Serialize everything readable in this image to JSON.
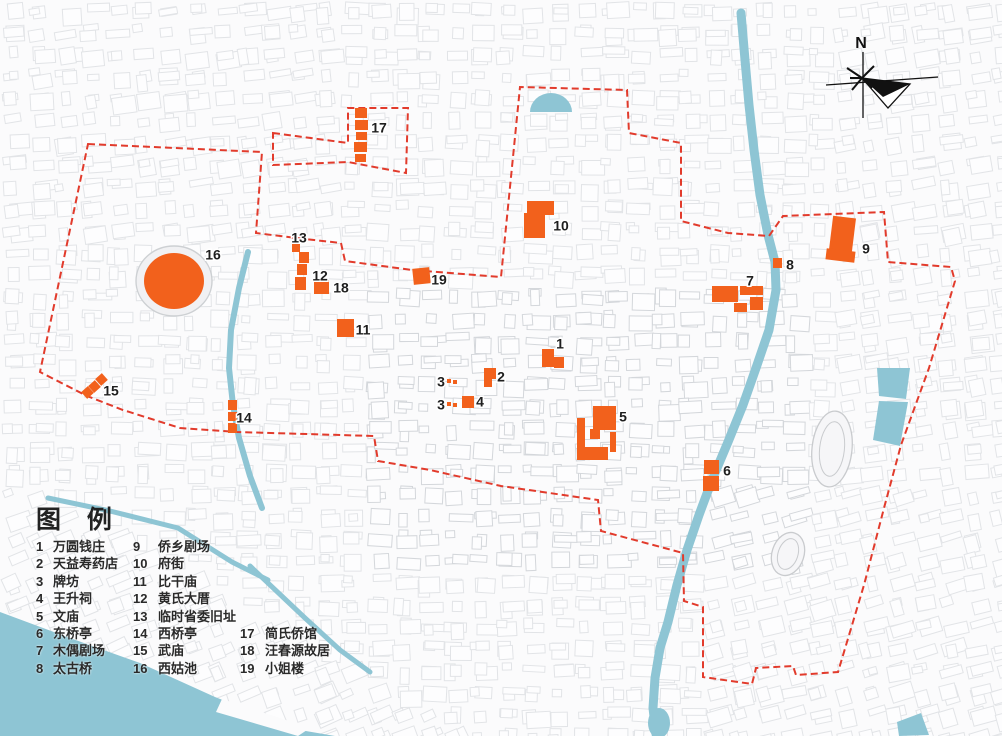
{
  "title": "历史街区保护规划图",
  "colors": {
    "site_orange": "#f2611c",
    "boundary_red": "#e23b2c",
    "water_teal": "#8ec5d4",
    "fabric_line": "#e2e4e7",
    "fabric_line_dense": "#d4d7db",
    "text": "#262626"
  },
  "north_indicator": {
    "label": "N"
  },
  "legend": {
    "title": "图  例",
    "columns": [
      {
        "items": [
          {
            "num": "1",
            "label": "万圆钱庄"
          },
          {
            "num": "2",
            "label": "天益寿药店"
          },
          {
            "num": "3",
            "label": "牌坊"
          },
          {
            "num": "4",
            "label": "王升祠"
          },
          {
            "num": "5",
            "label": "文庙"
          },
          {
            "num": "6",
            "label": "东桥亭"
          },
          {
            "num": "7",
            "label": "木偶剧场"
          },
          {
            "num": "8",
            "label": "太古桥"
          }
        ]
      },
      {
        "items": [
          {
            "num": "9",
            "label": "侨乡剧场"
          },
          {
            "num": "10",
            "label": "府街"
          },
          {
            "num": "11",
            "label": "比干庙"
          },
          {
            "num": "12",
            "label": "黄氏大厝"
          },
          {
            "num": "13",
            "label": "临时省委旧址"
          },
          {
            "num": "14",
            "label": "西桥亭"
          },
          {
            "num": "15",
            "label": "武庙"
          },
          {
            "num": "16",
            "label": "西姑池"
          }
        ]
      },
      {
        "items": [
          {
            "num": "17",
            "label": "简氏侨馆"
          },
          {
            "num": "18",
            "label": "汪春源故居"
          },
          {
            "num": "19",
            "label": "小姐楼"
          }
        ]
      }
    ]
  },
  "map": {
    "markers": [
      {
        "n": "1",
        "x": 560,
        "y": 345
      },
      {
        "n": "2",
        "x": 501,
        "y": 378
      },
      {
        "n": "3",
        "x": 441,
        "y": 383
      },
      {
        "n": "3",
        "x": 441,
        "y": 406
      },
      {
        "n": "4",
        "x": 480,
        "y": 403
      },
      {
        "n": "5",
        "x": 623,
        "y": 418
      },
      {
        "n": "6",
        "x": 727,
        "y": 472
      },
      {
        "n": "7",
        "x": 750,
        "y": 282
      },
      {
        "n": "8",
        "x": 790,
        "y": 266
      },
      {
        "n": "9",
        "x": 866,
        "y": 250
      },
      {
        "n": "10",
        "x": 561,
        "y": 227
      },
      {
        "n": "11",
        "x": 363,
        "y": 331
      },
      {
        "n": "12",
        "x": 320,
        "y": 277
      },
      {
        "n": "13",
        "x": 299,
        "y": 239
      },
      {
        "n": "14",
        "x": 244,
        "y": 419
      },
      {
        "n": "15",
        "x": 111,
        "y": 392
      },
      {
        "n": "16",
        "x": 213,
        "y": 256
      },
      {
        "n": "17",
        "x": 379,
        "y": 129
      },
      {
        "n": "18",
        "x": 341,
        "y": 289
      },
      {
        "n": "19",
        "x": 439,
        "y": 281
      }
    ],
    "site_rects": [
      {
        "site": "1",
        "r": [
          [
            542,
            349,
            12,
            18,
            0
          ],
          [
            554,
            357,
            10,
            11,
            0
          ]
        ]
      },
      {
        "site": "2",
        "r": [
          [
            484,
            368,
            12,
            11,
            0
          ],
          [
            484,
            379,
            8,
            8,
            0
          ]
        ]
      },
      {
        "site": "3",
        "r": [
          [
            447,
            379,
            4,
            4,
            0
          ],
          [
            453,
            380,
            4,
            4,
            0
          ],
          [
            447,
            402,
            4,
            4,
            0
          ],
          [
            453,
            403,
            4,
            4,
            0
          ]
        ]
      },
      {
        "site": "4",
        "r": [
          [
            462,
            396,
            12,
            12,
            0
          ]
        ]
      },
      {
        "site": "5",
        "r": [
          [
            593,
            406,
            23,
            24,
            0
          ],
          [
            577,
            418,
            8,
            42,
            0
          ],
          [
            580,
            447,
            28,
            13,
            0
          ],
          [
            590,
            429,
            10,
            10,
            0
          ],
          [
            610,
            432,
            6,
            20,
            0
          ]
        ]
      },
      {
        "site": "6",
        "r": [
          [
            704,
            460,
            15,
            14,
            0
          ],
          [
            703,
            476,
            16,
            15,
            0
          ]
        ]
      },
      {
        "site": "7",
        "r": [
          [
            712,
            286,
            26,
            16,
            0
          ],
          [
            740,
            286,
            23,
            9,
            0
          ],
          [
            750,
            297,
            13,
            13,
            0
          ],
          [
            734,
            303,
            13,
            9,
            0
          ]
        ]
      },
      {
        "site": "8",
        "r": [
          [
            773,
            258,
            9,
            10,
            0
          ]
        ]
      },
      {
        "site": "9",
        "r": [
          [
            831,
            217,
            23,
            34,
            7
          ],
          [
            826,
            250,
            29,
            11,
            7
          ]
        ]
      },
      {
        "site": "10",
        "r": [
          [
            527,
            201,
            27,
            14,
            0
          ],
          [
            524,
            213,
            21,
            25,
            0
          ]
        ]
      },
      {
        "site": "11",
        "r": [
          [
            337,
            319,
            17,
            18,
            0
          ]
        ]
      },
      {
        "site": "12",
        "r": [
          [
            299,
            252,
            10,
            11,
            0
          ],
          [
            297,
            264,
            10,
            11,
            0
          ],
          [
            295,
            277,
            11,
            13,
            0
          ]
        ]
      },
      {
        "site": "13",
        "r": [
          [
            292,
            244,
            8,
            8,
            0
          ]
        ]
      },
      {
        "site": "14",
        "r": [
          [
            228,
            400,
            9,
            10,
            0
          ],
          [
            228,
            412,
            9,
            9,
            0
          ],
          [
            228,
            423,
            9,
            10,
            0
          ]
        ]
      },
      {
        "site": "15",
        "r": [
          [
            83,
            388,
            9,
            9,
            -42
          ],
          [
            90,
            382,
            9,
            9,
            -42
          ],
          [
            97,
            375,
            9,
            9,
            -42
          ]
        ]
      },
      {
        "site": "17",
        "r": [
          [
            355,
            108,
            12,
            10,
            0
          ],
          [
            355,
            120,
            13,
            10,
            0
          ],
          [
            356,
            132,
            11,
            8,
            0
          ],
          [
            354,
            142,
            13,
            10,
            0
          ],
          [
            355,
            154,
            11,
            8,
            0
          ]
        ]
      },
      {
        "site": "18",
        "r": [
          [
            314,
            280,
            15,
            14,
            0
          ]
        ]
      },
      {
        "site": "19",
        "r": [
          [
            413,
            268,
            17,
            16,
            -6
          ]
        ]
      }
    ],
    "site_pond": {
      "site": "16",
      "cx": 174,
      "cy": 281,
      "rx": 30,
      "ry": 28
    },
    "boundary_main": [
      [
        88,
        144
      ],
      [
        262,
        152
      ],
      [
        256,
        233
      ],
      [
        296,
        238
      ],
      [
        341,
        243
      ],
      [
        345,
        261
      ],
      [
        412,
        270
      ],
      [
        501,
        277
      ],
      [
        520,
        87
      ],
      [
        627,
        90
      ],
      [
        629,
        133
      ],
      [
        681,
        143
      ],
      [
        681,
        221
      ],
      [
        728,
        233
      ],
      [
        769,
        236
      ],
      [
        783,
        216
      ],
      [
        884,
        212
      ],
      [
        888,
        262
      ],
      [
        951,
        267
      ],
      [
        955,
        281
      ],
      [
        929,
        368
      ],
      [
        901,
        445
      ],
      [
        884,
        508
      ],
      [
        864,
        585
      ],
      [
        838,
        672
      ],
      [
        796,
        675
      ],
      [
        793,
        666
      ],
      [
        756,
        668
      ],
      [
        752,
        684
      ],
      [
        703,
        677
      ],
      [
        703,
        607
      ],
      [
        684,
        601
      ],
      [
        683,
        553
      ],
      [
        601,
        531
      ],
      [
        598,
        500
      ],
      [
        501,
        486
      ],
      [
        430,
        470
      ],
      [
        378,
        461
      ],
      [
        374,
        436
      ],
      [
        237,
        432
      ],
      [
        180,
        428
      ],
      [
        123,
        410
      ],
      [
        87,
        396
      ],
      [
        40,
        372
      ]
    ],
    "boundary_annex": [
      [
        273,
        133
      ],
      [
        348,
        143
      ],
      [
        348,
        108
      ],
      [
        408,
        108
      ],
      [
        406,
        173
      ],
      [
        348,
        162
      ],
      [
        273,
        165
      ]
    ],
    "canals": [
      {
        "w": 9,
        "pts": [
          [
            741,
            13
          ],
          [
            745,
            60
          ],
          [
            749,
            105
          ],
          [
            754,
            150
          ],
          [
            760,
            195
          ],
          [
            768,
            235
          ],
          [
            775,
            262
          ],
          [
            776,
            290
          ],
          [
            769,
            330
          ],
          [
            756,
            368
          ],
          [
            743,
            405
          ],
          [
            728,
            442
          ],
          [
            712,
            480
          ],
          [
            699,
            515
          ],
          [
            687,
            550
          ],
          [
            677,
            585
          ],
          [
            668,
            622
          ],
          [
            660,
            648
          ],
          [
            655,
            678
          ],
          [
            653,
            708
          ],
          [
            656,
            734
          ]
        ]
      },
      {
        "w": 6,
        "pts": [
          [
            248,
            252
          ],
          [
            239,
            288
          ],
          [
            231,
            330
          ],
          [
            229,
            368
          ],
          [
            233,
            405
          ],
          [
            239,
            438
          ],
          [
            250,
            476
          ],
          [
            262,
            508
          ]
        ]
      },
      {
        "w": 5,
        "pts": [
          [
            48,
            498
          ],
          [
            110,
            511
          ],
          [
            178,
            528
          ],
          [
            232,
            562
          ],
          [
            268,
            580
          ]
        ]
      },
      {
        "w": 5,
        "pts": [
          [
            250,
            566
          ],
          [
            305,
            618
          ],
          [
            340,
            650
          ],
          [
            370,
            672
          ]
        ]
      }
    ],
    "canal_mouth": {
      "cx": 659,
      "cy": 723,
      "rx": 11,
      "ry": 15
    },
    "waters": {
      "harbor": [
        [
          0,
          612
        ],
        [
          70,
          638
        ],
        [
          140,
          663
        ],
        [
          215,
          697
        ],
        [
          300,
          730
        ],
        [
          335,
          736
        ],
        [
          0,
          736
        ]
      ],
      "quay_wedge": [
        [
          222,
          699
        ],
        [
          310,
          728
        ],
        [
          298,
          736
        ],
        [
          216,
          712
        ]
      ],
      "dome_pond": {
        "cx": 551,
        "cy": 112,
        "r": 21
      },
      "lake1": [
        [
          877,
          368
        ],
        [
          910,
          368
        ],
        [
          906,
          399
        ],
        [
          879,
          396
        ]
      ],
      "lake2": [
        [
          879,
          401
        ],
        [
          908,
          402
        ],
        [
          900,
          446
        ],
        [
          873,
          440
        ]
      ],
      "corner_blob": [
        [
          897,
          722
        ],
        [
          921,
          713
        ],
        [
          929,
          735
        ],
        [
          899,
          736
        ]
      ]
    },
    "tracks": [
      {
        "cx": 832,
        "cy": 449,
        "rx": 20,
        "ry": 38,
        "rot": 6
      },
      {
        "cx": 788,
        "cy": 554,
        "rx": 16,
        "ry": 22,
        "rot": 18
      }
    ]
  }
}
